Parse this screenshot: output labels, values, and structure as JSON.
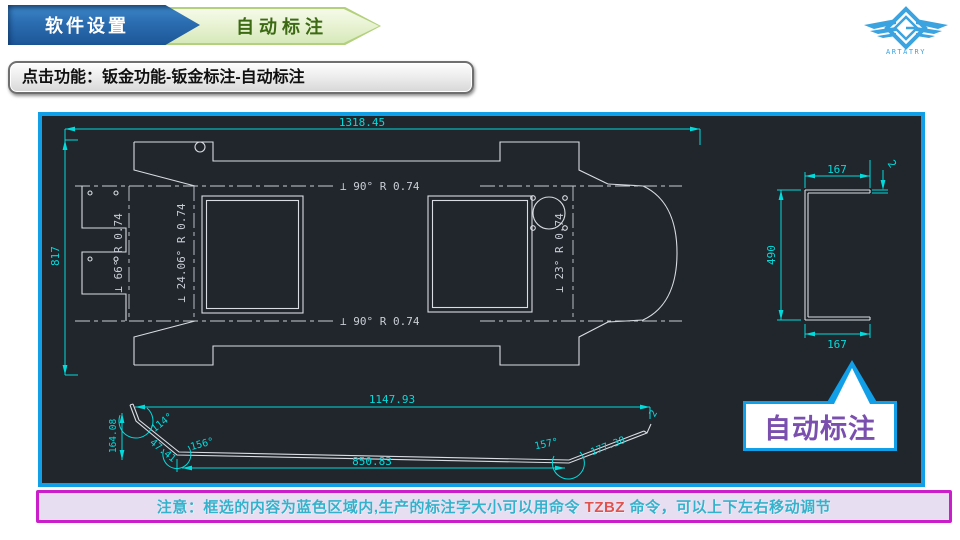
{
  "header": {
    "step1_label": "软件设置",
    "step2_label": "自动标注"
  },
  "instruction_text": "点击功能：钣金功能-钣金标注-自动标注",
  "logo_text": "ARTATRY",
  "cad": {
    "dim_width": "1318.45",
    "dim_height": "817",
    "bend_top": "⊥  90°   R 0.74",
    "bend_bottom": "⊥  90°   R 0.74",
    "bend_left": "⊥ 66°  R 0.74",
    "bend_mid": "⊥ 24.06°  R 0.74",
    "bend_right": "⊥ 23°  R 0.74",
    "side": {
      "flange_top": "167",
      "height": "490",
      "flange_bottom": "167",
      "thickness": "2"
    },
    "profile": {
      "width_top": "1147.93",
      "width_bottom": "850.83",
      "height_left": "164.08",
      "angle_left": "114°",
      "angle_mid": "156°",
      "angle_right": "157°",
      "len_left": "47.41",
      "len_right": "177.38",
      "thickness": "2"
    }
  },
  "callout_label": "自动标注",
  "note": {
    "prefix": "注意：框选的内容为蓝色区域内,生产的标注字大小可以用命令 ",
    "command": "TZBZ",
    "suffix": " 命令，可以上下左右移动调节"
  },
  "colors": {
    "accent_blue": "#119fe8",
    "dim_cyan": "#00dcdc",
    "outline_white": "#d9dde3",
    "note_border_magenta": "#cb1ecb",
    "callout_purple": "#7a4fae",
    "command_red": "#e0524e",
    "logo_blue": "#3ba3e0"
  }
}
